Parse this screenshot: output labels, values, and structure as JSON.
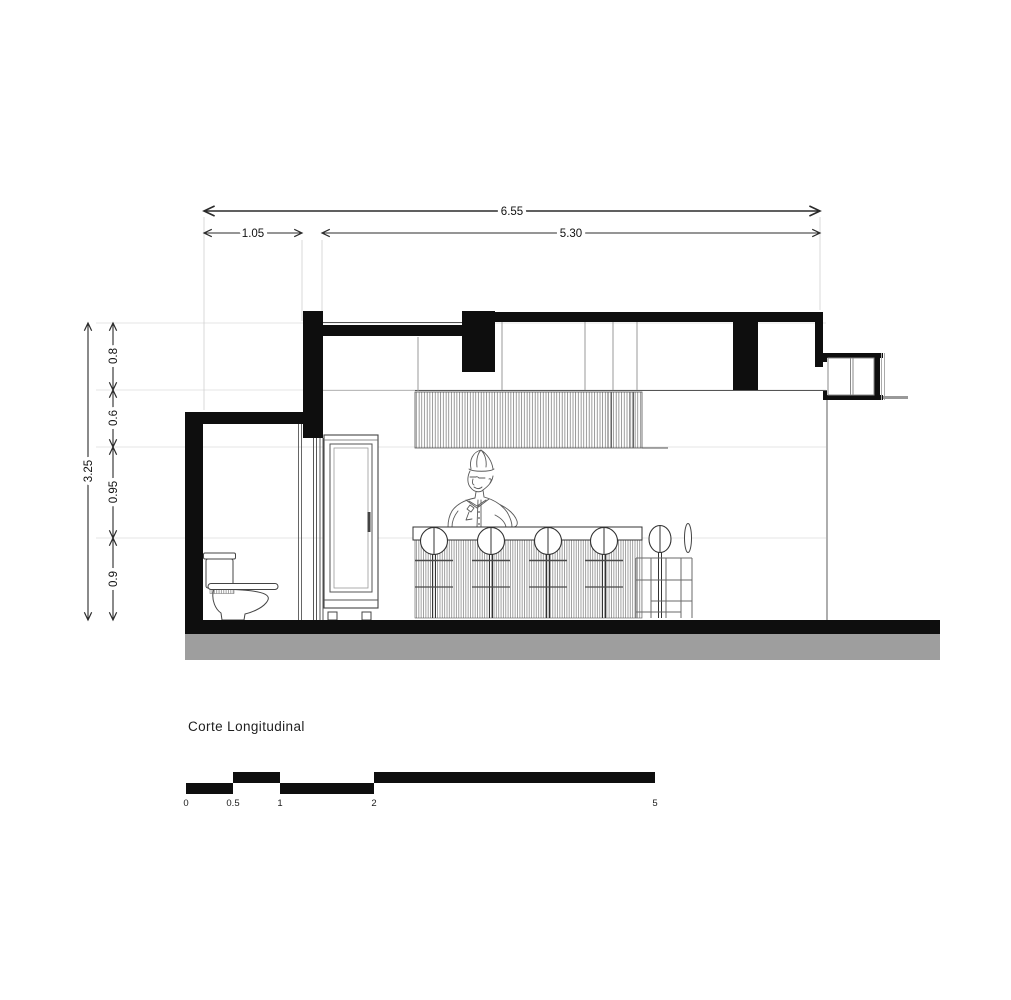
{
  "drawing": {
    "title": "Corte Longitudinal",
    "horizontal_dimensions": {
      "total": "6.55",
      "bathroom": "1.05",
      "main_room": "5.30"
    },
    "vertical_dimensions": {
      "total": "3.25",
      "roof_band": "0.8",
      "ceiling_band": "0.6",
      "upper_wall": "0.95",
      "counter_height": "0.9"
    },
    "scale_bar": {
      "labels": [
        "0",
        "0.5",
        "1",
        "2",
        "5"
      ]
    },
    "colors": {
      "ink_black": "#0e0e0e",
      "ground_gray": "#9e9e9e",
      "dimension_line": "#2b2b2b",
      "reference_line": "#e4e4e4"
    }
  }
}
